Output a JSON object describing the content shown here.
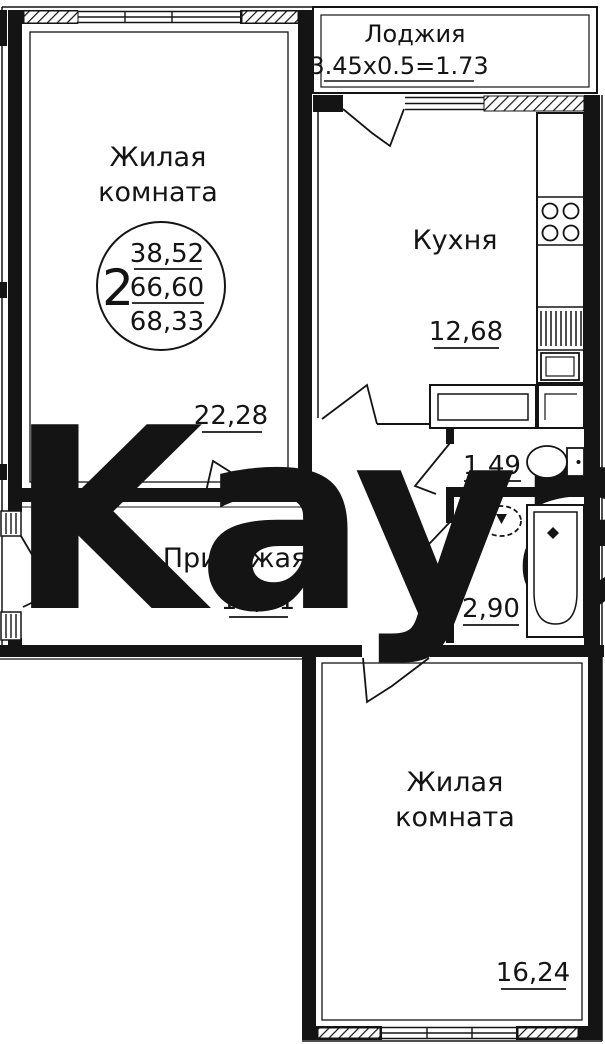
{
  "watermark": {
    "text": "Kayan",
    "color": "#f6d6d9"
  },
  "stamp": {
    "rooms_count": "2",
    "living_area": "38,52",
    "area_mid": "66,60",
    "area_total": "68,33"
  },
  "rooms": {
    "living_top": {
      "line1": "Жилая",
      "line2": "комната",
      "area": "22,28"
    },
    "loggia": {
      "name": "Лоджия",
      "dims": "3.45x0.5=1.73"
    },
    "kitchen": {
      "name": "Кухня",
      "area": "12,68"
    },
    "wc": {
      "area": "1,49"
    },
    "bathroom": {
      "area": "2,90"
    },
    "hallway": {
      "name": "Прихожая",
      "area": "11,01"
    },
    "living_bottom": {
      "line1": "Жилая",
      "line2": "комната",
      "area": "16,24"
    }
  }
}
